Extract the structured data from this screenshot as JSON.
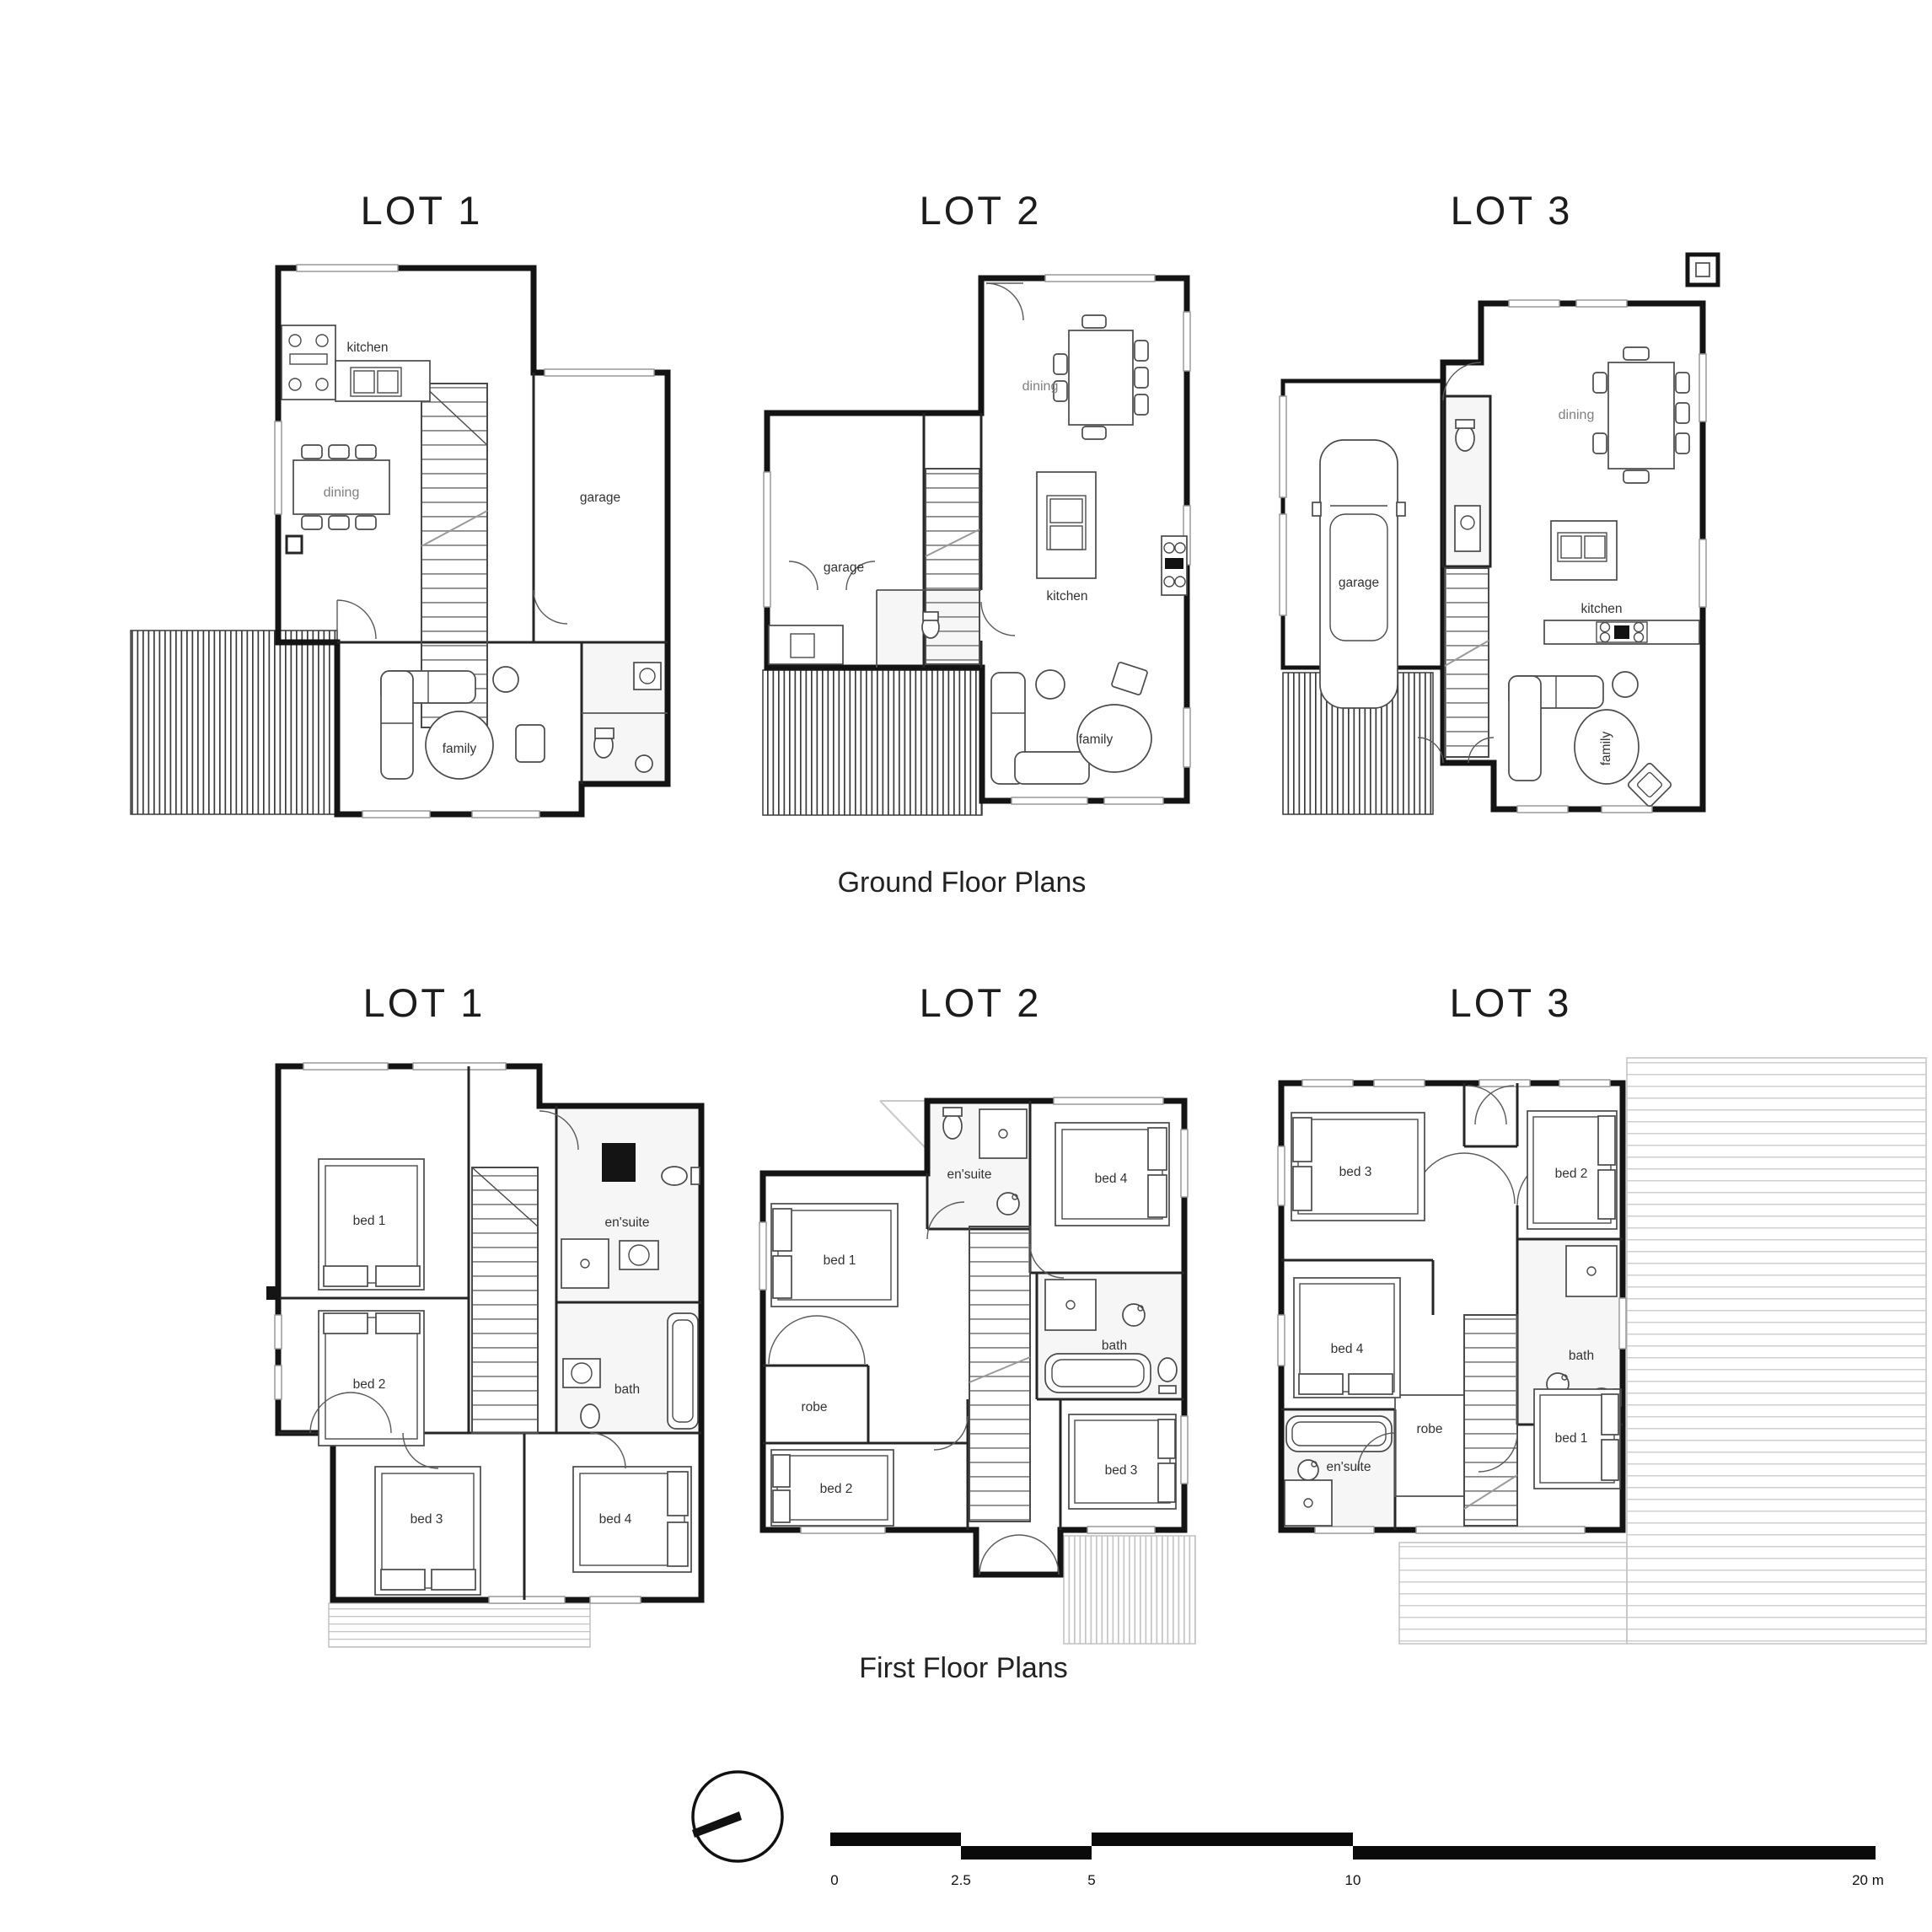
{
  "colors": {
    "wall": "#141414",
    "room_label": "#333333",
    "dining_label": "#7f7f7f",
    "deck_hatch": "#3a3a3a",
    "light_deck_hatch": "#c4c4c4",
    "background": "#ffffff"
  },
  "ground": {
    "caption": "Ground Floor Plans",
    "lot1": {
      "title": "LOT 1",
      "rooms": {
        "kitchen": "kitchen",
        "dining": "dining",
        "garage": "garage",
        "family": "family"
      }
    },
    "lot2": {
      "title": "LOT 2",
      "rooms": {
        "garage": "garage",
        "dining": "dining",
        "kitchen": "kitchen",
        "family": "family"
      }
    },
    "lot3": {
      "title": "LOT 3",
      "rooms": {
        "garage": "garage",
        "dining": "dining",
        "kitchen": "kitchen",
        "family": "family"
      }
    }
  },
  "first": {
    "caption": "First Floor Plans",
    "lot1": {
      "title": "LOT 1",
      "rooms": {
        "bed1": "bed 1",
        "bed2": "bed 2",
        "bed3": "bed 3",
        "bed4": "bed 4",
        "ensuite": "en'suite",
        "bath": "bath"
      }
    },
    "lot2": {
      "title": "LOT 2",
      "rooms": {
        "bed1": "bed 1",
        "bed2": "bed 2",
        "bed3": "bed 3",
        "bed4": "bed 4",
        "ensuite": "en'suite",
        "bath": "bath",
        "robe": "robe"
      }
    },
    "lot3": {
      "title": "LOT 3",
      "rooms": {
        "bed1": "bed 1",
        "bed2": "bed 2",
        "bed3": "bed 3",
        "bed4": "bed 4",
        "ensuite": "en'suite",
        "bath": "bath",
        "robe": "robe"
      }
    }
  },
  "scale_bar": {
    "tick0": "0",
    "tick1": "2.5",
    "tick2": "5",
    "tick3": "10",
    "tick4": "20 m"
  },
  "icons": {
    "north_arrow": "north-arrow-icon"
  }
}
